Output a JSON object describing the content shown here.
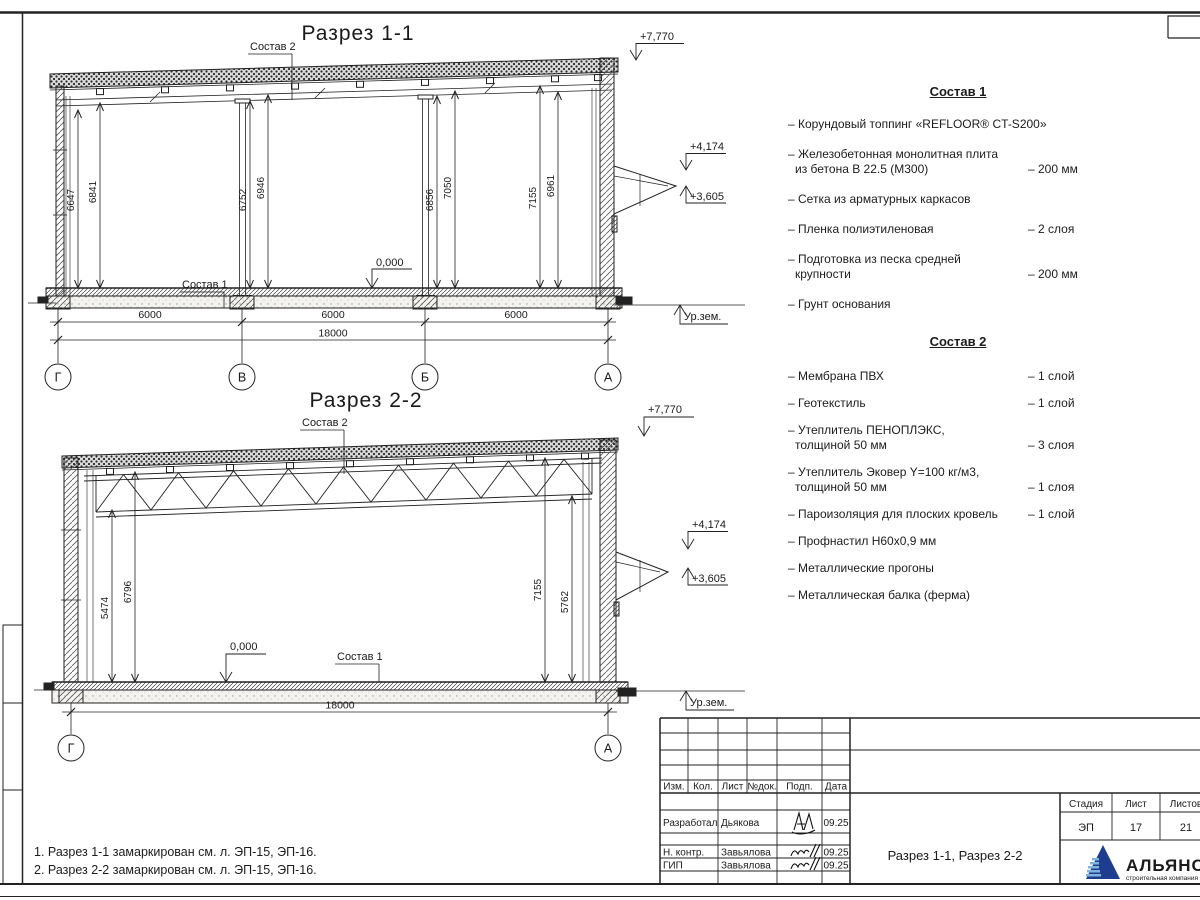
{
  "section1": {
    "title": "Разрез 1-1",
    "sostav2_label": "Состав 2",
    "sostav1_label": "Состав 1",
    "elev_roof": "+7,770",
    "elev_canopy_top": "+4,174",
    "elev_canopy_bottom": "+3,605",
    "elev_zero": "0,000",
    "ground_label": "Ур.зем.",
    "vdims": [
      "6647",
      "6841",
      "6752",
      "6946",
      "6856",
      "7050",
      "7155",
      "6961"
    ],
    "hdims": [
      "6000",
      "6000",
      "6000"
    ],
    "total_dim": "18000",
    "axes": [
      "Г",
      "В",
      "Б",
      "А"
    ]
  },
  "section2": {
    "title": "Разрез 2-2",
    "sostav2_label": "Состав 2",
    "sostav1_label": "Состав 1",
    "elev_roof": "+7,770",
    "elev_canopy_top": "+4,174",
    "elev_canopy_bottom": "+3,605",
    "elev_zero": "0,000",
    "ground_label": "Ур.зем.",
    "vdims": [
      "5474",
      "6796",
      "7155",
      "5762"
    ],
    "total_dim": "18000",
    "axes": [
      "Г",
      "А"
    ]
  },
  "sostav1": {
    "title": "Состав 1",
    "items": [
      {
        "l1": "– Корундовый топпинг «REFLOOR® CT-S200»"
      },
      {
        "l1": "– Железобетонная  монолитная плита",
        "l2": "из бетона В 22.5 (М300)",
        "v2": "– 200 мм"
      },
      {
        "l1": "– Сетка из арматурных каркасов"
      },
      {
        "l1": "– Пленка полиэтиленовая",
        "v1": "– 2 слоя"
      },
      {
        "l1": "– Подготовка из песка средней",
        "l2": "крупности",
        "v2": "– 200 мм"
      },
      {
        "l1": "– Грунт основания"
      }
    ]
  },
  "sostav2": {
    "title": "Состав 2",
    "items": [
      {
        "l1": "– Мембрана ПВХ",
        "v1": "– 1 слой"
      },
      {
        "l1": "– Геотекстиль",
        "v1": "– 1 слой"
      },
      {
        "l1": "– Утеплитель ПЕНОПЛЭКС,",
        "l2": "толщиной 50 мм",
        "v2": "– 3 слоя"
      },
      {
        "l1": "– Утеплитель Эковер Y=100 кг/м3,",
        "l2": "толщиной 50 мм",
        "v2": "– 1 слоя"
      },
      {
        "l1": "– Пароизоляция для плоских кровель",
        "v1": "– 1 слой"
      },
      {
        "l1": "– Профнастил Н60х0,9 мм"
      },
      {
        "l1": "– Металлические прогоны"
      },
      {
        "l1": "– Металлическая балка (ферма)"
      }
    ]
  },
  "notes": {
    "line1": "1. Разрез 1-1 замаркирован см. л. ЭП-15, ЭП-16.",
    "line2": "2. Разрез 2-2 замаркирован см. л. ЭП-15, ЭП-16."
  },
  "titleblock": {
    "col_izm": "Изм.",
    "col_kol": "Кол.",
    "col_list": "Лист",
    "col_doc": "№док.",
    "col_podp": "Подп.",
    "col_data": "Дата",
    "row1_role": "Разработал",
    "row1_name": "Дьякова",
    "row1_date": "09.25",
    "row2_role": "Н. контр.",
    "row2_name": "Завьялова",
    "row2_date": "09.25",
    "row3_role": "ГИП",
    "row3_name": "Завьялова",
    "row3_date": "09.25",
    "doc_title": "Разрез 1-1, Разрез 2-2",
    "stage_label": "Стадия",
    "sheet_label": "Лист",
    "sheets_label": "Листов",
    "stage": "ЭП",
    "sheet": "17",
    "sheets": "21",
    "logo_name": "АЛЬЯНС",
    "logo_sub": "строительная компания",
    "colors": {
      "logo_navy": "#1e3d8f",
      "logo_light": "#7fb2dd",
      "logo_red": "#c14040"
    }
  }
}
